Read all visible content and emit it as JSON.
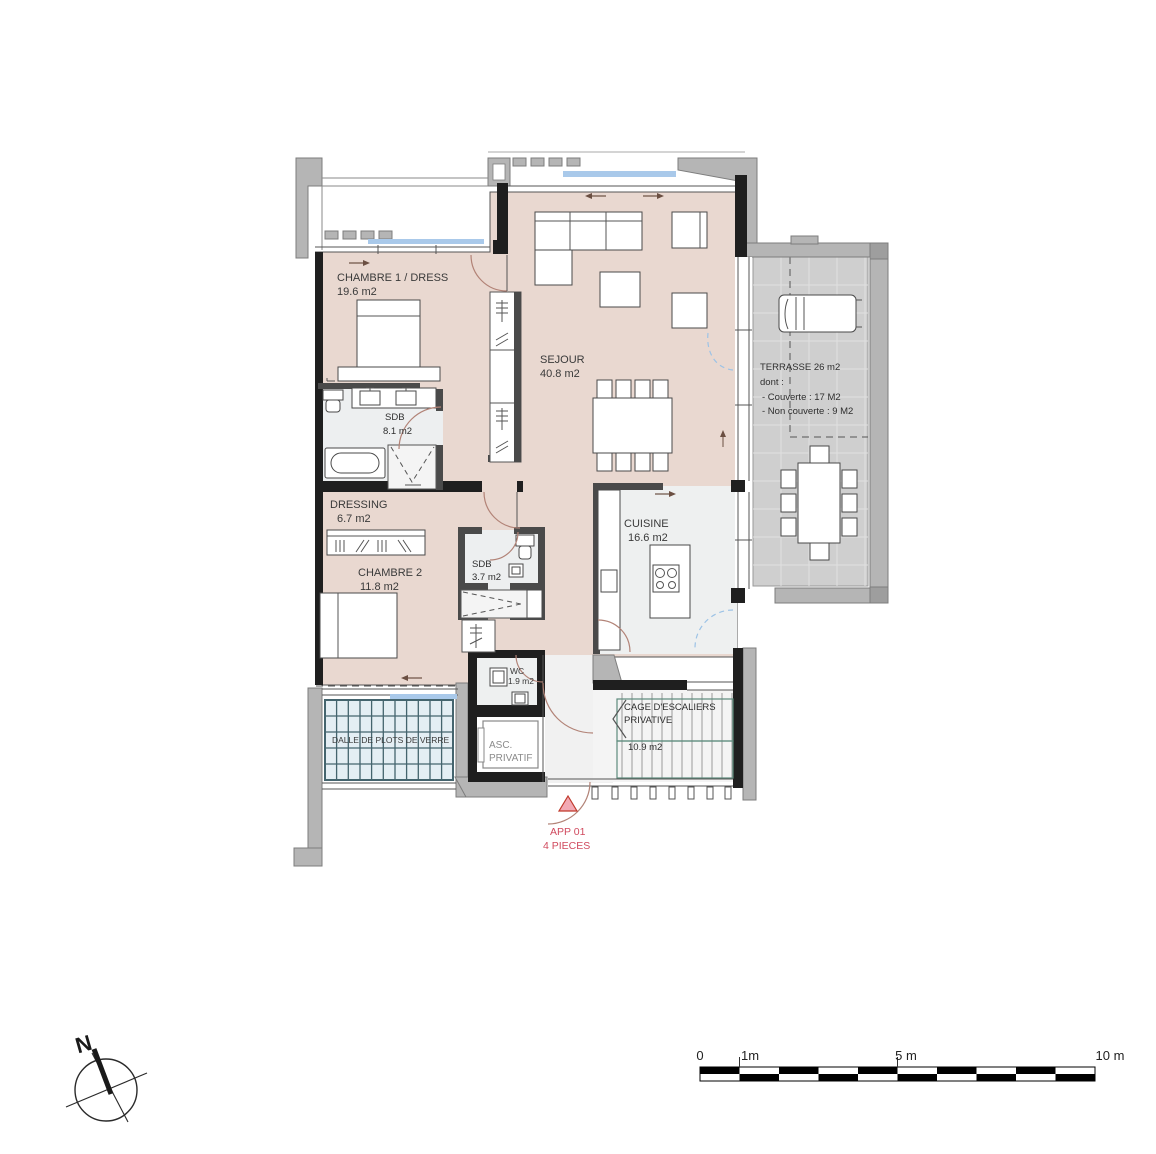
{
  "plan_title": "floor plan APP 01",
  "rooms": {
    "chambre1": {
      "name": "CHAMBRE 1 / DRESS",
      "area": "19.6 m2"
    },
    "sejour": {
      "name": "SEJOUR",
      "area": "40.8 m2"
    },
    "sdb1": {
      "name": "SDB",
      "area": "8.1 m2"
    },
    "dressing": {
      "name": "DRESSING",
      "area": "6.7 m2"
    },
    "chambre2": {
      "name": "CHAMBRE 2",
      "area": "11.8 m2"
    },
    "sdb2": {
      "name": "SDB",
      "area": "3.7 m2"
    },
    "cuisine": {
      "name": "CUISINE",
      "area": "16.6 m2"
    },
    "wc": {
      "name": "WC",
      "area": "1.9 m2"
    },
    "terrasse": {
      "name": "TERRASSE  26 m2",
      "dont": "dont :",
      "couverte": "- Couverte : 17 M2",
      "non_couverte": "- Non couverte : 9 M2"
    },
    "dalle": {
      "name": "DALLE DE PLOTS DE VERRE"
    },
    "ascenseur": {
      "l1": "ASC.",
      "l2": "PRIVATIF"
    },
    "cage": {
      "l1": "CAGE D'ESCALIERS",
      "l2": "PRIVATIVE",
      "area": "10.9 m2"
    }
  },
  "entry": {
    "l1": "APP 01",
    "l2": "4 PIECES"
  },
  "compass": {
    "north": "N"
  },
  "scale": {
    "t0": "0",
    "t1": "1m",
    "t5": "5 m",
    "t10": "10 m"
  },
  "colors": {
    "floor_pink": "#e9d8d0",
    "floor_gray": "#edeff0",
    "terrace_gray": "#cfcfcf",
    "glass_blue": "#e4eef4",
    "glazing_blue": "#a9c9ea",
    "wall_black": "#1f1f1f",
    "wall_gray": "#b5b5b5",
    "door_arc": "#b28377",
    "stair_teal": "#5d8b7c",
    "marker_red": "#d04a5e"
  }
}
